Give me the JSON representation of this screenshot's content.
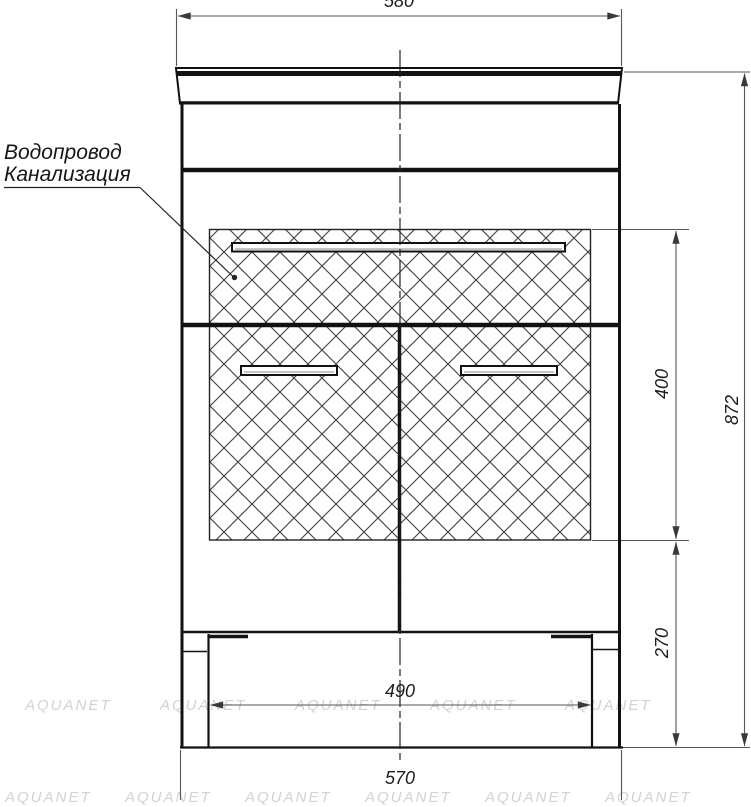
{
  "annotation": {
    "line1": "Водопровод",
    "line2": "Канализация"
  },
  "dims": {
    "top_width": "580",
    "overall_height": "872",
    "service_zone_height": "400",
    "base_height": "270",
    "inner_width": "490",
    "body_width": "570"
  },
  "watermark": {
    "text": "AQUANET"
  },
  "colors": {
    "object_line": "#121212",
    "dimension_line": "#565656",
    "hatch_line": "#3f3f3f",
    "watermark": "#d2d2d2",
    "background": "#ffffff"
  }
}
